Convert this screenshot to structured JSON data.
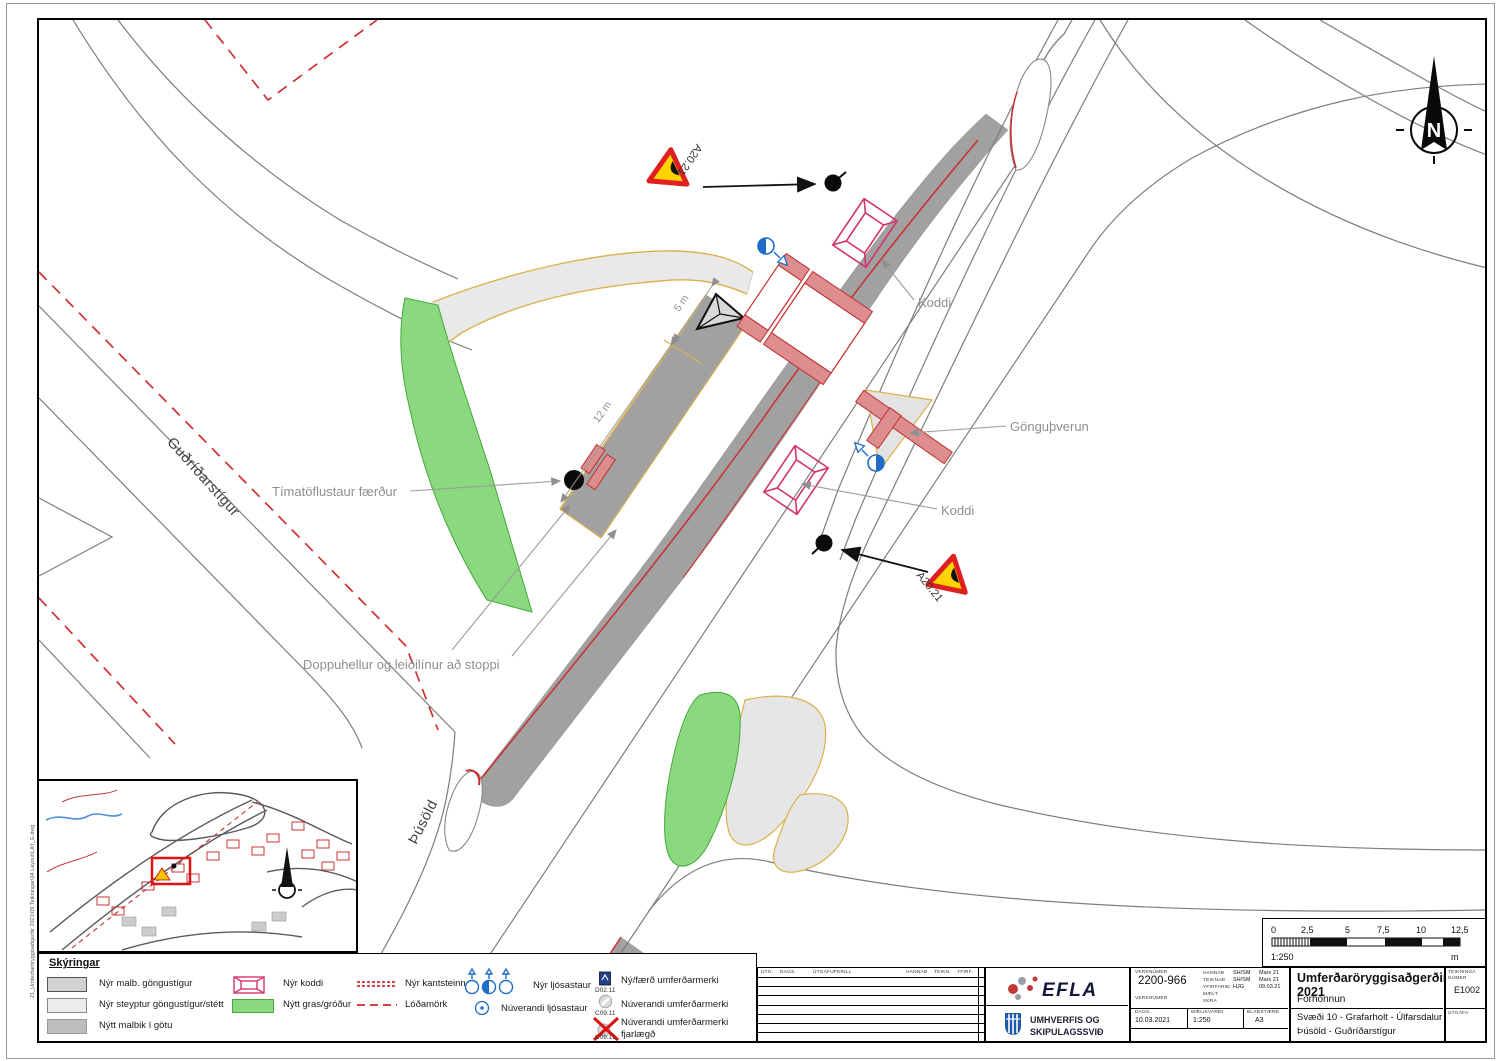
{
  "sheet": {
    "margin_note": "21_Umferðaröryggisaðgerðir 2021\\09 Teikningar\\04 Layout\\LAY_E.dwg"
  },
  "plan": {
    "north": "N",
    "streets": {
      "gudridarstigur": "Guðríðarstígur",
      "thusold": "Þúsöld"
    },
    "annotations": {
      "timatoflustaur": "Tímatöflustaur færður",
      "doppuhellur": "Doppuhellur og leiðilínur að stoppi",
      "koddi_upper": "Koddi",
      "koddi_lower": "Koddi",
      "gonguthverun": "Gönguþverun",
      "sign_top": "A20.21",
      "sign_bottom": "A20.21",
      "dim_short": "5 m",
      "dim_long": "12 m"
    }
  },
  "legend": {
    "title": "Skýringar",
    "items": [
      {
        "label": "Nýr malb. göngustígur"
      },
      {
        "label": "Nýr steyptur göngustígur/stétt"
      },
      {
        "label": "Nýtt malbik í götu"
      },
      {
        "label": "Nýr koddi"
      },
      {
        "label": "Nýtt gras/gróður"
      },
      {
        "label": "Nýr kantsteinn"
      },
      {
        "label": "Lóðamörk"
      },
      {
        "label": "Nýr ljósastaur"
      },
      {
        "label": "Núverandi ljósastaur"
      },
      {
        "label": "Ný/færð umferðarmerki",
        "code": "D02.11"
      },
      {
        "label": "Núverandi umferðarmerki",
        "code": "C09.11"
      },
      {
        "label": "Núverandi umferðarmerki fjarlægð",
        "code": "C09.11"
      }
    ]
  },
  "revisions": {
    "col_utg": "ÚTG.",
    "col_dags": "DAGS.",
    "col_ferill": "ÚTGÁFUFERILL",
    "col_hannad": "HANNAÐ",
    "col_teikn": "TEIKN.",
    "col_yfirf": "YFIRF."
  },
  "company": {
    "logo": "EFLA",
    "dept1": "UMHVERFIS OG",
    "dept2": "SKIPULAGSSVIÐ"
  },
  "titleblock": {
    "verknumer_label": "VERKNÚMER",
    "verknumer": "2200-966",
    "verkkaupi_label": "VERKNÚMER",
    "hannad_label": "HANNAÐ",
    "hannad": "SH/SM",
    "hannad_date": "Mars 21",
    "teiknad_label": "TEIKNAÐ",
    "teiknad": "SH/SM",
    "teiknad_date": "Mars 21",
    "yfirfarid_label": "YFIRFARIÐ",
    "yfirfarid": "HJG",
    "yfirfarid_date": "09.03.21",
    "maelt_label": "MÆLT",
    "skra_label": "SKRÁ",
    "dags_label": "DAGS.",
    "dags": "10.03.2021",
    "maelikvardi_label": "MÆLIKVARÐI",
    "maelikvardi": "1:250",
    "bladstaerd_label": "BLAÐSTÆRÐ",
    "bladstaerd": "A3",
    "title": "Umferðaröryggisaðgerðir 2021",
    "phase": "Forhönnun",
    "area1": "Svæði 10 - Grafarholt - Úlfarsdalur",
    "area2": "Þúsöld - Guðríðarstígur",
    "teikn_nr_label": "TEIKNINGA NÚMER",
    "teikn_nr": "E1002",
    "utgafa_label": "ÚTGÁFA"
  },
  "scalebar": {
    "ticks": [
      "0",
      "2,5",
      "5",
      "7,5",
      "10",
      "12,5"
    ],
    "ratio": "1:250",
    "unit": "m"
  }
}
